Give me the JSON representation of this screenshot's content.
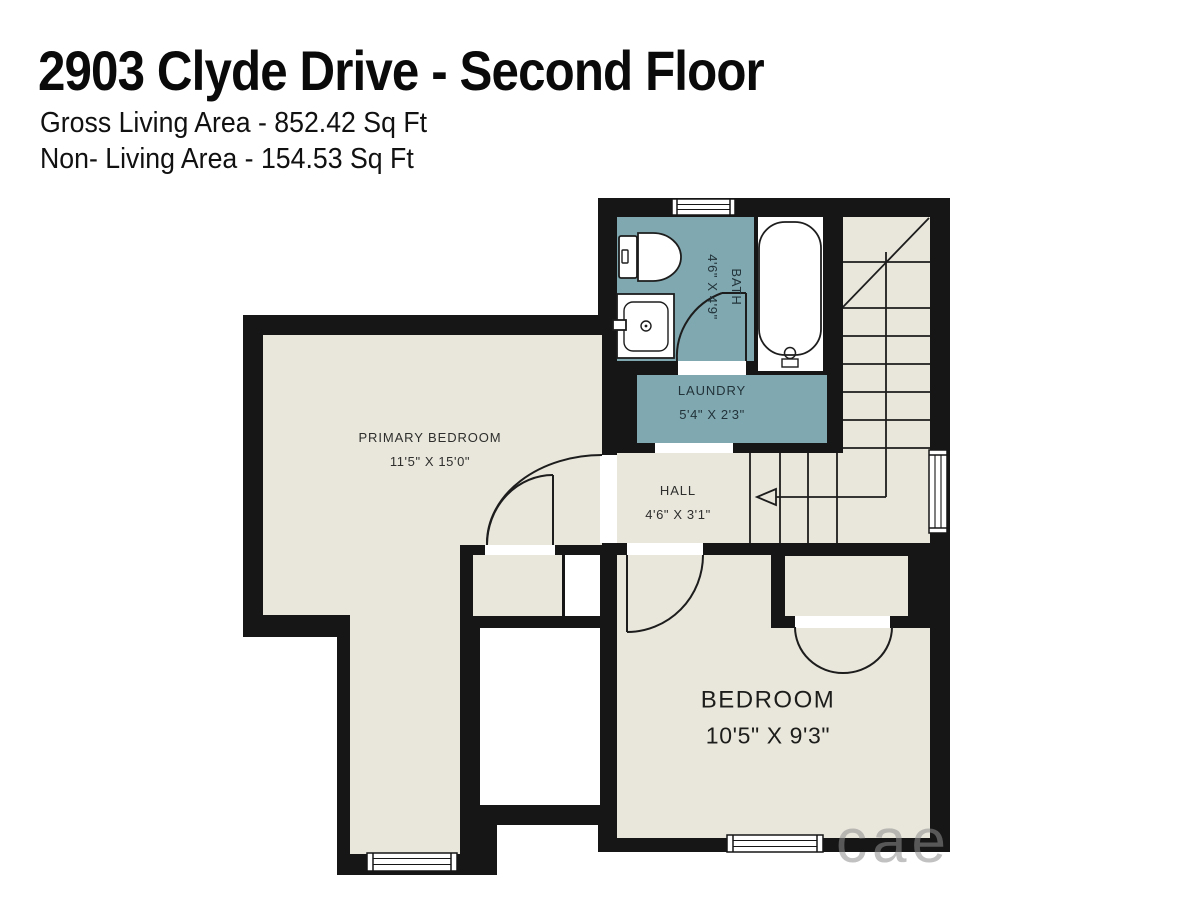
{
  "header": {
    "title": "2903 Clyde Drive - Second Floor",
    "gross_living": "Gross Living Area - 852.42 Sq Ft",
    "non_living": "Non- Living Area - 154.53 Sq Ft"
  },
  "rooms": {
    "primary_bedroom": {
      "name": "PRIMARY BEDROOM",
      "dims": "11'5\" X 15'0\""
    },
    "bath": {
      "name": "BATH",
      "dims": "4'6\" X 4'9\""
    },
    "laundry": {
      "name": "LAUNDRY",
      "dims": "5'4\" X 2'3\""
    },
    "hall": {
      "name": "HALL",
      "dims": "4'6\" X 3'1\""
    },
    "bedroom": {
      "name": "BEDROOM",
      "dims": "10'5\" X 9'3\""
    }
  },
  "watermark": {
    "text": "cae"
  },
  "colors": {
    "wall": "#161616",
    "floor": "#e9e7dc",
    "wet_room": "#80a8b0",
    "line": "#1d1d1d"
  }
}
